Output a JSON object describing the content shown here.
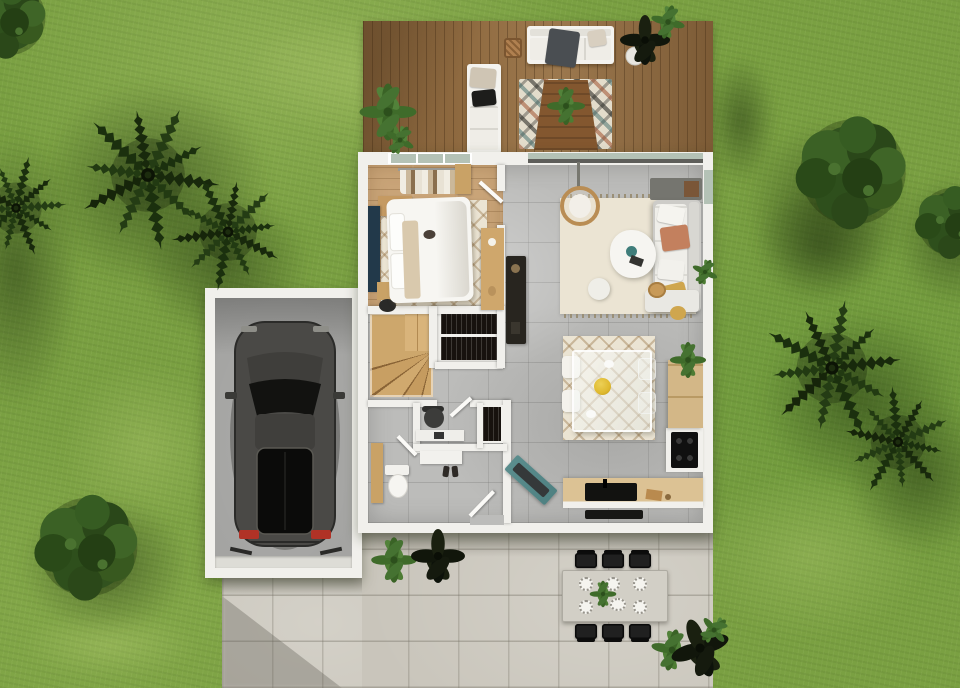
{
  "title": "Aerial 3D render of a single-storey house with garden, wooden deck, garage and concrete patio",
  "colors": {
    "grass_base": "#7aa042",
    "grass_light": "#8fb054",
    "deck_wood": "#8f6a40",
    "wall": "#f1f0ec",
    "tile": "#bcbcba",
    "wood_floor": "#c9a478",
    "rug": "#ebe4d3",
    "patio": "#c9c5bb",
    "garage_floor": "#a2a2a0",
    "stairs_wood": "#cda76c",
    "car_body": "#4a4946",
    "accent_teal": "#4f8182",
    "accent_terracotta": "#c3805e",
    "accent_mustard": "#cfa64e",
    "accent_navy": "#22394a",
    "clothes_dark": "#17120e",
    "counter_wood": "#dcc294",
    "bowl_yellow": "#dfb92f",
    "tail_light_red": "#b03226",
    "plant_green": "#3f6b2a",
    "plant_dark": "#11160b",
    "bush_green": "#32521f",
    "palm_green": "#1b2e0e",
    "sofa_white": "#f4f3ef",
    "chair_black": "#202020",
    "window_glass": "#b4c2b6"
  },
  "scene": {
    "garden": {
      "lawn": "grass lawn",
      "palm_trees": 5,
      "round_bushes": 4,
      "potted_plants": 8
    },
    "deck": {
      "material": "wood planks",
      "furniture": [
        "outdoor sofa with throw",
        "cushioned bench",
        "wicker lantern",
        "patterned rug",
        "low wood table with plant",
        "potted plants"
      ]
    },
    "house": {
      "rooms": [
        {
          "name": "bedroom",
          "furniture": [
            "double bed",
            "lattice rug",
            "desk with chair",
            "navy console",
            "nightstand",
            "stool",
            "wood console",
            "clothes rack",
            "cat on bed"
          ]
        },
        {
          "name": "living-room",
          "furniture": [
            "rattan hanging chair",
            "corner sofa with pillows",
            "organic coffee table",
            "pouf",
            "baskets",
            "fringed rug",
            "dark sideboard",
            "sliding glass door"
          ]
        },
        {
          "name": "dining-area",
          "furniture": [
            "glass table",
            "four chairs",
            "lattice rug",
            "yellow fruit bowl"
          ]
        },
        {
          "name": "kitchen",
          "furniture": [
            "wood counter with black sink",
            "cooktop column",
            "tall cabinet with plant",
            "black mat"
          ]
        },
        {
          "name": "hallway",
          "furniture": [
            "study desk",
            "office chair",
            "mini wardrobe",
            "shoe console",
            "shoes",
            "teal bench"
          ]
        },
        {
          "name": "wc",
          "furniture": [
            "toilet",
            "tall wood cabinet"
          ]
        },
        {
          "name": "staircase",
          "furniture": [
            "winder wood stairs",
            "wardrobe with dark clothes"
          ]
        }
      ]
    },
    "garage": {
      "vehicle": "dark grey car seen from above",
      "door": "garage door with floor tracks"
    },
    "patio": {
      "material": "concrete pavers",
      "dining_set": {
        "table": 1,
        "chairs": 6,
        "place_settings": 6,
        "centerpiece": "plant and dish"
      }
    }
  }
}
